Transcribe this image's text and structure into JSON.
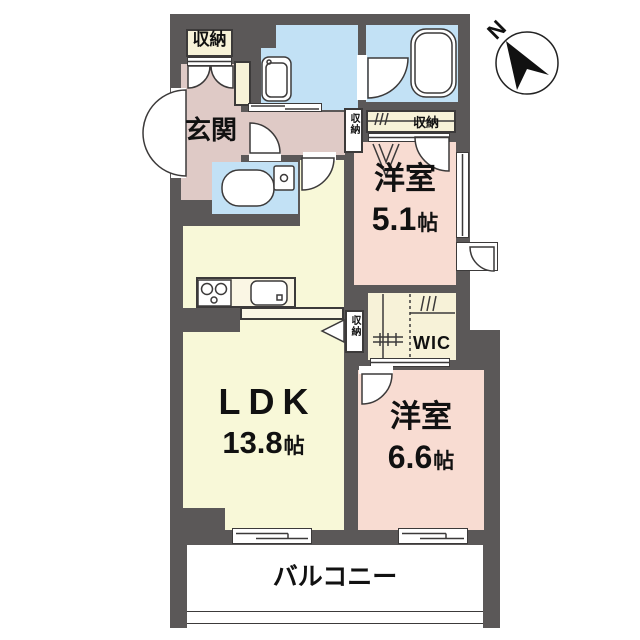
{
  "compass": {
    "north_label": "N"
  },
  "rooms": {
    "entrance": {
      "label": "玄関"
    },
    "entrance_storage": {
      "label": "収納"
    },
    "hall_storage": {
      "label": "収納"
    },
    "western_room_1": {
      "label": "洋室",
      "size_value": "5.1",
      "size_unit": "帖",
      "closet_label": "収納"
    },
    "ldk": {
      "label": "LDK",
      "size_value": "13.8",
      "size_unit": "帖",
      "storage_label": "収納"
    },
    "wic": {
      "label": "WIC"
    },
    "western_room_2": {
      "label": "洋室",
      "size_value": "6.6",
      "size_unit": "帖"
    },
    "balcony": {
      "label": "バルコニー"
    }
  },
  "colors": {
    "wall": "#5b5858",
    "ldk": "#f8f8d8",
    "western_room": "#f8dcd2",
    "entrance_hall": "#dfcac6",
    "wet_area": "#c2e1f5",
    "storage": "#f7f2d8",
    "counter": "#faf6e4",
    "balcony": "#ffffff",
    "line": "#333333"
  }
}
